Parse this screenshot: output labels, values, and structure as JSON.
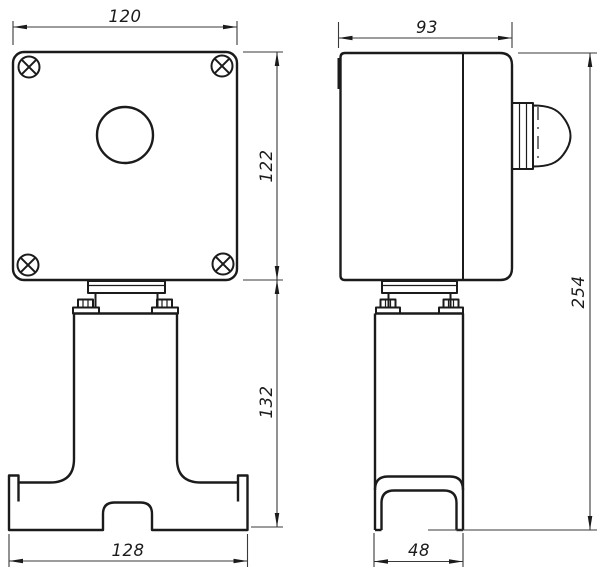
{
  "drawing": {
    "kind": "technical-dimension-drawing",
    "background_color": "#ffffff",
    "line_color": "#1b1b1b",
    "views": {
      "front": {
        "label": "front-view",
        "features": [
          "enclosure-box",
          "phillips-screws-4x",
          "pushbutton-hole",
          "mounting-flange",
          "bolts-2x",
          "stand-column",
          "base-bracket-with-notch"
        ],
        "dimensions": {
          "top_width": "120",
          "box_height": "122",
          "stand_height": "132",
          "base_width": "128"
        }
      },
      "side": {
        "label": "side-view",
        "features": [
          "enclosure-box",
          "lid-seam",
          "cable-gland",
          "mounting-flange",
          "bolts-2x",
          "stand-column",
          "channel-feet"
        ],
        "dimensions": {
          "top_depth": "93",
          "total_height": "254",
          "base_depth": "48"
        }
      }
    }
  }
}
